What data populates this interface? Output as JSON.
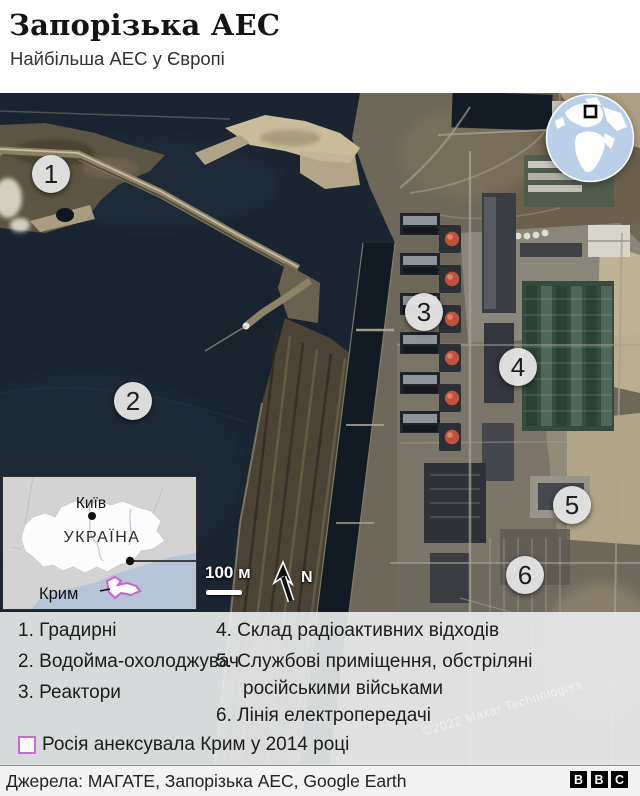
{
  "header": {
    "title": "Запорізька АЕС",
    "subtitle": "Найбільша АЕС у Європі"
  },
  "map": {
    "markers": [
      {
        "number": "1"
      },
      {
        "number": "2"
      },
      {
        "number": "3"
      },
      {
        "number": "4"
      },
      {
        "number": "5"
      },
      {
        "number": "6"
      }
    ],
    "scale_label": "100 м",
    "north_label": "N",
    "watermark": "©2022 Maxar Technologies"
  },
  "inset": {
    "city": "Київ",
    "country": "УКРАЇНА",
    "region": "Крим"
  },
  "legend": {
    "items": [
      {
        "number": "1.",
        "label": "Градирні"
      },
      {
        "number": "2.",
        "label": "Водойма-охолоджувач"
      },
      {
        "number": "3.",
        "label": "Реактори"
      },
      {
        "number": "4.",
        "label": "Склад радіоактивних відходів"
      },
      {
        "number": "5.",
        "label": "Службові приміщення, обстріляні російськими військами"
      },
      {
        "number": "6.",
        "label": "Лінія електропередачі"
      }
    ],
    "crimea_note": "Росія анексувала Крим у 2014 році",
    "crimea_color": "#c969d2"
  },
  "footer": {
    "source": "Джерела: МАГАТЕ, Запорізька АЕС, Google Earth",
    "logo_letters": [
      "B",
      "B",
      "C"
    ]
  }
}
